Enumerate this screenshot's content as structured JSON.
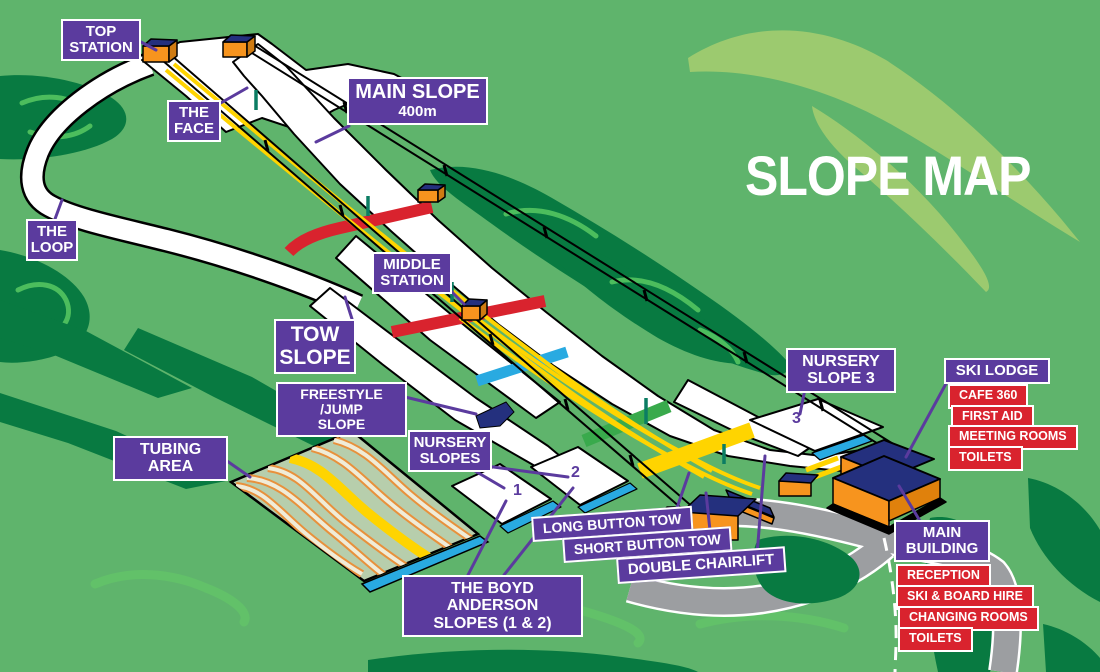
{
  "title": {
    "text": "SLOPE MAP"
  },
  "colors": {
    "background_green": "#5fb46c",
    "forest_green": "#087a41",
    "highlight_light_green": "#9cca6f",
    "squiggle_green": "#4cbd5d",
    "label_purple": "#5b3b9e",
    "facility_red": "#d9232e",
    "piste_white": "#ffffff",
    "tow_yellow": "#ffd400",
    "band_red": "#d9232e",
    "band_blue": "#29aae1",
    "band_green": "#39aa4c",
    "building_orange": "#f7941e",
    "roof_navy": "#24307e",
    "road_grey": "#9c9ea1",
    "tubing_fill": "#b7ceac"
  },
  "map_labels": {
    "top_station": {
      "line1": "TOP",
      "line2": "STATION"
    },
    "the_face": {
      "line1": "THE",
      "line2": "FACE"
    },
    "main_slope": {
      "line1": "MAIN SLOPE",
      "line2": "400m"
    },
    "the_loop": {
      "line1": "THE",
      "line2": "LOOP"
    },
    "middle_station": {
      "line1": "MIDDLE",
      "line2": "STATION"
    },
    "tow_slope": {
      "line1": "TOW",
      "line2": "SLOPE"
    },
    "freestyle_jump": {
      "line1": "FREESTYLE /JUMP",
      "line2": "SLOPE"
    },
    "tubing_area": {
      "text": "TUBING AREA"
    },
    "nursery_slopes": {
      "line1": "NURSERY",
      "line2": "SLOPES"
    },
    "nursery_slope_3": {
      "line1": "NURSERY",
      "line2": "SLOPE 3"
    },
    "long_button_tow": {
      "text": "LONG BUTTON TOW"
    },
    "short_button_tow": {
      "text": "SHORT BUTTON TOW"
    },
    "double_chairlift": {
      "text": "DOUBLE CHAIRLIFT"
    },
    "boyd_anderson": {
      "line1": "THE BOYD ANDERSON",
      "line2": "SLOPES (1 & 2)"
    }
  },
  "ski_lodge": {
    "title": "SKI LODGE",
    "facilities": [
      "CAFE 360",
      "FIRST AID",
      "MEETING ROOMS",
      "TOILETS"
    ]
  },
  "main_building": {
    "title_line1": "MAIN",
    "title_line2": "BUILDING",
    "facilities": [
      "RECEPTION",
      "SKI & BOARD HIRE",
      "CHANGING ROOMS",
      "TOILETS"
    ]
  },
  "slope_numbers": {
    "n1": "1",
    "n2": "2",
    "n3": "3"
  }
}
